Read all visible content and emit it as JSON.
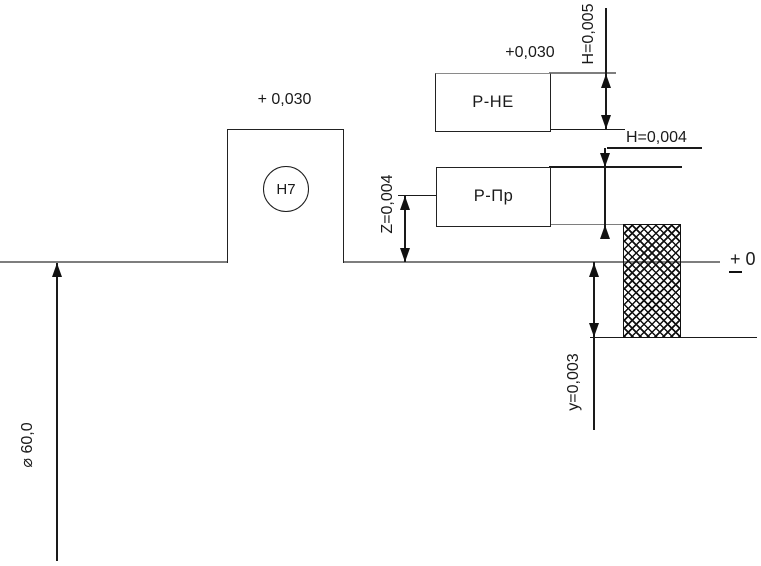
{
  "diagram": {
    "zero_line_label": {
      "sign": "+",
      "value": "0"
    },
    "shaft_diameter_label": "⌀ 60,0",
    "hole": {
      "tolerance_symbol": "H7",
      "upper_deviation": "+ 0,030"
    },
    "nogo_gauge": {
      "label": "Р-НЕ",
      "upper_deviation": "+0,030",
      "tolerance_label": "H=0,005"
    },
    "go_gauge": {
      "label": "Р-Пр",
      "tolerance_label": "H=0,004",
      "z_offset_label": "Z=0,004"
    },
    "wear_limit_label": "y=0,003"
  },
  "colors": {
    "line": "#1a1a1a",
    "thin_line": "#7e7e7e",
    "background": "#ffffff"
  }
}
